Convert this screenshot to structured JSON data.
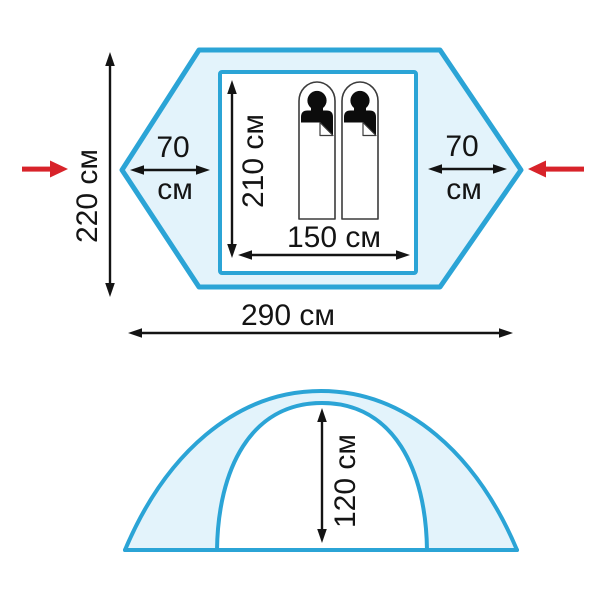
{
  "diagram": {
    "subject": "tent dimensions",
    "unit_label": "см",
    "colors": {
      "outline": "#2ba4d6",
      "fill_light": "#e3f3fb",
      "dim": "#141414",
      "red_arrow": "#d8232a",
      "figure": "#0c0c0c",
      "bag_outline": "#3c3c3c",
      "bg": "#ffffff"
    },
    "top_view": {
      "total_width_label": "290 см",
      "total_depth_label": "220 см",
      "inner_length_label": "210 см",
      "inner_width_label": "150 см",
      "vestibule_left_value": "70",
      "vestibule_left_unit": "см",
      "vestibule_right_value": "70",
      "vestibule_right_unit": "см",
      "sleeping_places": 2
    },
    "side_view": {
      "peak_height_label": "120 см"
    }
  }
}
